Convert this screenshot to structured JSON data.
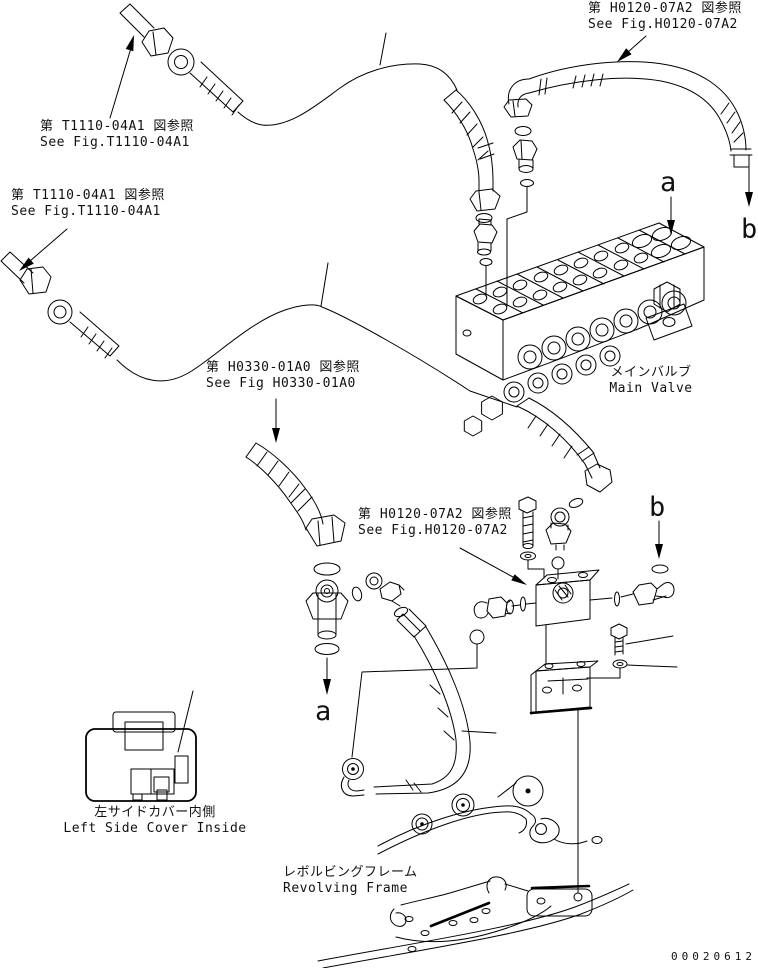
{
  "page": {
    "background": "#ffffff",
    "ink": "#000000",
    "drawing_number": "00020612"
  },
  "references": {
    "t1110_top": {
      "jp": "第 T1110-04A1 図参照",
      "en": "See Fig.T1110-04A1"
    },
    "t1110_left": {
      "jp": "第 T1110-04A1 図参照",
      "en": "See Fig.T1110-04A1"
    },
    "h0120_top": {
      "jp": "第 H0120-07A2 図参照",
      "en": "See Fig.H0120-07A2"
    },
    "h0330_mid": {
      "jp": "第 H0330-01A0 図参照",
      "en": "See Fig H0330-01A0"
    },
    "h0120_mid": {
      "jp": "第 H0120-07A2 図参照",
      "en": "See Fig.H0120-07A2"
    }
  },
  "captions": {
    "main_valve": {
      "jp": "メインバルブ",
      "en": "Main Valve"
    },
    "left_side_cover": {
      "jp": "左サイドカバー内側",
      "en": "Left Side Cover Inside"
    },
    "revolving_frame": {
      "jp": "レボルビングフレーム",
      "en": "Revolving Frame"
    }
  },
  "port_markers": {
    "a_top": "a",
    "b_top": "b",
    "a_bottom": "a",
    "b_mid": "b"
  }
}
